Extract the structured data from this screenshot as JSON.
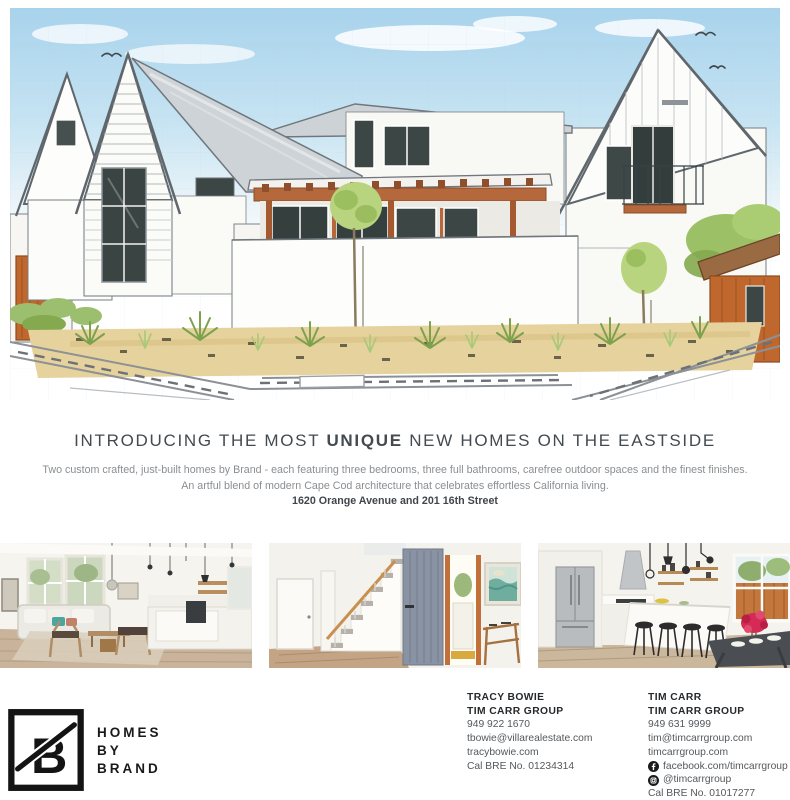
{
  "headline": {
    "pre": "INTRODUCING THE MOST ",
    "emphasis": "UNIQUE",
    "post": " NEW HOMES ON THE EASTSIDE"
  },
  "intro": {
    "line1": "Two custom crafted, just-built homes by Brand - each featuring three bedrooms, three full bathrooms, carefree outdoor spaces and the finest finishes.",
    "line2": "An artful blend of modern Cape Cod architecture that celebrates effortless California living.",
    "address": "1620 Orange Avenue and 201 16th Street"
  },
  "logo": {
    "mark": "B",
    "line1": "HOMES",
    "line2": "BY",
    "line3": "BRAND"
  },
  "contacts": [
    {
      "name": "TRACY BOWIE",
      "group": "TIM CARR GROUP",
      "phone": "949 922 1670",
      "email": "tbowie@villarealestate.com",
      "website": "tracybowie.com",
      "license": "Cal BRE No. 01234314"
    },
    {
      "name": "TIM CARR",
      "group": "TIM CARR GROUP",
      "phone": "949 631 9999",
      "email": "tim@timcarrgroup.com",
      "website": "timcarrgroup.com",
      "facebook": "facebook.com/timcarrgroup",
      "instagram": "@timcarrgroup",
      "license": "Cal BRE No. 01017277"
    }
  ],
  "colors": {
    "accent_orange": "#bf6a3a",
    "sky_blue": "#b9dcef",
    "roof_gray": "#cdd2d7",
    "text_dark": "#3f464c",
    "text_gray": "#8a8e92",
    "logo_black": "#141414"
  }
}
